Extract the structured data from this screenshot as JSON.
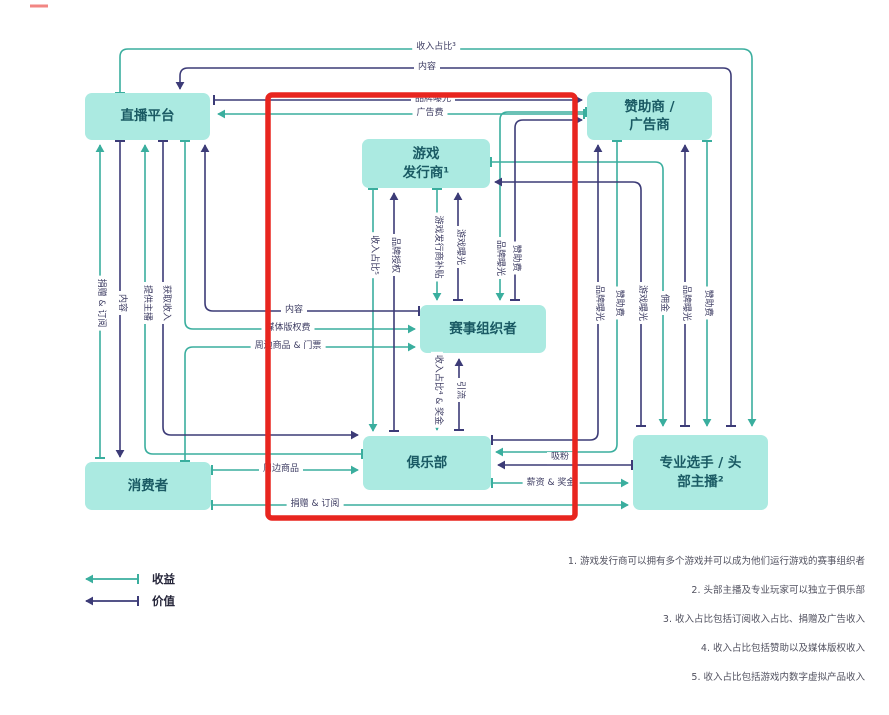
{
  "diagram_title": "esports-ecosystem-flow-diagram",
  "nodes": {
    "platform": "直播平台",
    "sponsor": "赞助商 /\n广告商",
    "publisher": "游戏\n发行商¹",
    "organizer": "赛事组织者",
    "club": "俱乐部",
    "consumer": "消费者",
    "players": "专业选手 / 头\n部主播²"
  },
  "labels": {
    "rev_share3": "收入占比³",
    "content": "内容",
    "brand_exposure": "品牌曝光",
    "ad_fee": "广告费",
    "donate_subscribe": "捐赠 & 订阅",
    "provide_streamers": "提供主播",
    "obtain_revenue": "获取收入",
    "media_rights": "媒体版权费",
    "merch_tickets": "周边商品 & 门票",
    "merch": "周边商品",
    "rev_share5": "收入占比⁵",
    "brand_license": "品牌授权",
    "publisher_subsidy": "游戏发行商补贴",
    "game_exposure": "游戏曝光",
    "sponsor_fee": "赞助费",
    "rev_share4_bonus": "收入占比⁴ & 奖金",
    "drive_traffic": "引流",
    "commission": "佣金",
    "attract_fans": "吸粉",
    "salary_bonus": "薪资 & 奖金"
  },
  "legend": {
    "revenue": "收益",
    "value": "价值"
  },
  "footnotes": [
    "1. 游戏发行商可以拥有多个游戏并可以成为他们运行游戏的赛事组织者",
    "2. 头部主播及专业玩家可以独立于俱乐部",
    "3. 收入占比包括订阅收入占比、捐赠及广告收入",
    "4. 收入占比包括赞助以及媒体版权收入",
    "5. 收入占比包括游戏内数字虚拟产品收入"
  ],
  "colors": {
    "revenue_teal": "#3AAE9E",
    "value_navy": "#3C3B77",
    "node_fill": "#ABEAE1",
    "node_text": "#1A5A64",
    "highlight_red": "#E8251F"
  }
}
